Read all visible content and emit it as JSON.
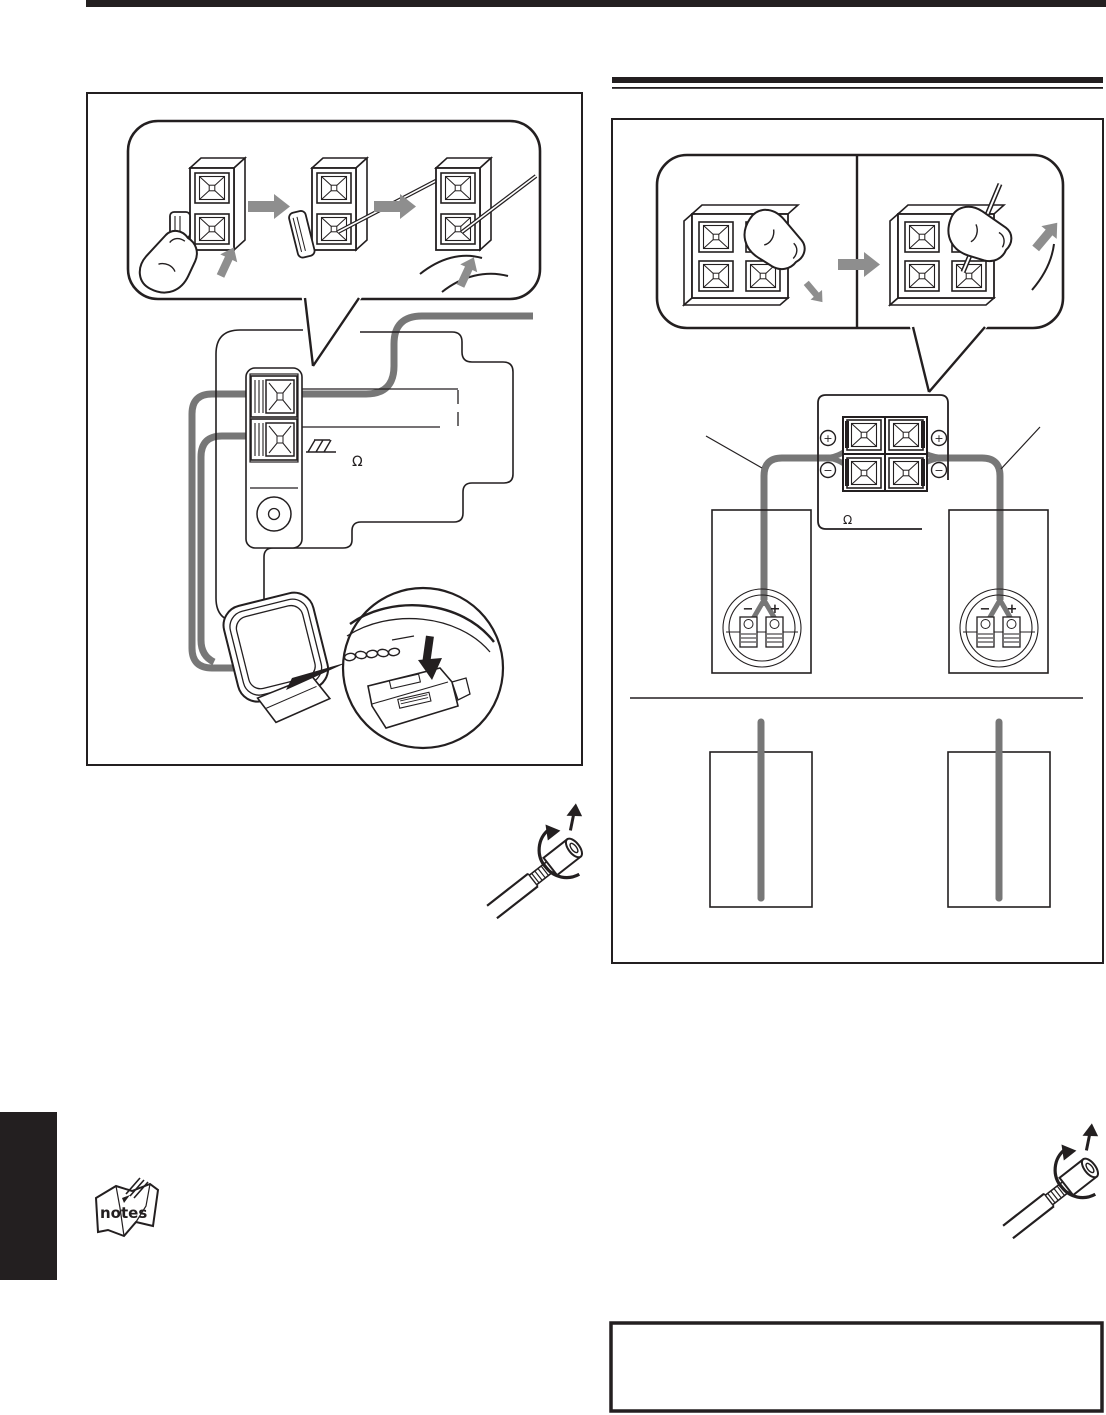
{
  "colors": {
    "ink": "#231f20",
    "wire": "#777777",
    "arrow": "#8e8e8e"
  },
  "left_figure": {
    "name": "am-loop-antenna-connection-diagram",
    "impedance_label": "Ω"
  },
  "right_figure": {
    "name": "speaker-cord-connection-diagram",
    "impedance_label": "Ω",
    "terminal_labels": {
      "plus": "+",
      "minus": "−"
    },
    "speaker_labels": {
      "plus": "+",
      "minus": "−"
    }
  },
  "notes_icon_label": "notes"
}
